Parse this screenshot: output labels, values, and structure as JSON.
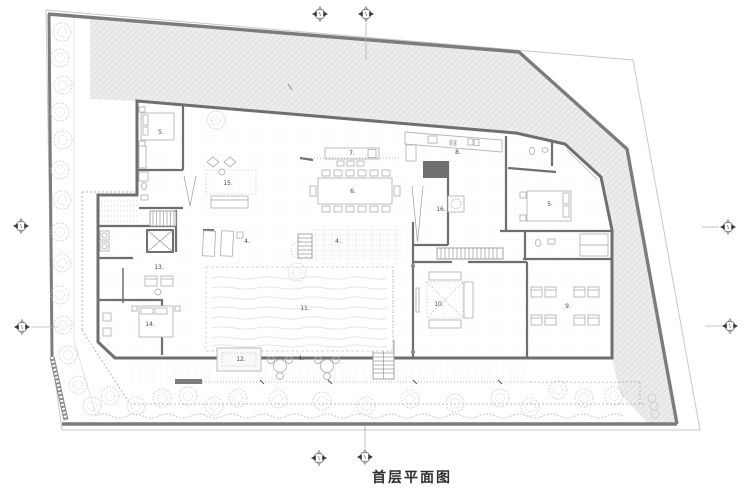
{
  "title": {
    "text": "首层平面图"
  },
  "rooms": [
    {
      "label": "5.",
      "x": 161,
      "y": 134
    },
    {
      "label": "15.",
      "x": 228,
      "y": 185
    },
    {
      "label": "7.",
      "x": 352,
      "y": 155
    },
    {
      "label": "6.",
      "x": 353,
      "y": 193
    },
    {
      "label": "8.",
      "x": 458,
      "y": 154
    },
    {
      "label": "16.",
      "x": 441,
      "y": 211
    },
    {
      "label": "5.",
      "x": 550,
      "y": 206
    },
    {
      "label": "4.",
      "x": 247,
      "y": 243
    },
    {
      "label": "4.",
      "x": 338,
      "y": 243
    },
    {
      "label": "13.",
      "x": 159,
      "y": 269
    },
    {
      "label": "14.",
      "x": 150,
      "y": 326
    },
    {
      "label": "11.",
      "x": 305,
      "y": 310
    },
    {
      "label": "12.",
      "x": 241,
      "y": 361
    },
    {
      "label": "4.",
      "x": 301,
      "y": 360
    },
    {
      "label": "10.",
      "x": 439,
      "y": 306
    },
    {
      "label": "9.",
      "x": 568,
      "y": 308
    }
  ],
  "colors": {
    "wall": "#6f6f6f",
    "site_wall": "#7c7c7c",
    "site_fill": "#ececec",
    "boundary": "#c8c8c8",
    "furniture": "#b5b5b5",
    "tree": "#cccccc",
    "label_text": "#4a4a4a",
    "title_text": "#303030"
  }
}
